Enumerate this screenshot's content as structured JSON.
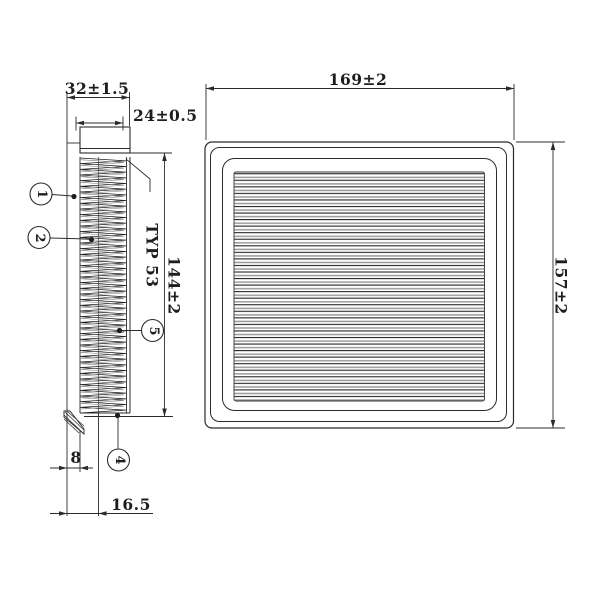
{
  "drawing": {
    "title": "air-filter-technical-drawing",
    "side_view": {
      "dim_overall_width": "32±1.5",
      "dim_pleat_width": "24±0.5",
      "dim_height": "144±2",
      "pleat_note": "TYP 53",
      "dim_flange": "8",
      "dim_offset": "16.5",
      "callouts": [
        "1",
        "2",
        "5",
        "4"
      ]
    },
    "top_view": {
      "dim_width": "169±2",
      "dim_height": "157±2"
    },
    "colors": {
      "line": "#2b2b2b",
      "thin_line": "#555555",
      "pleat_gray": "#9a9a9a",
      "background": "#ffffff"
    }
  }
}
